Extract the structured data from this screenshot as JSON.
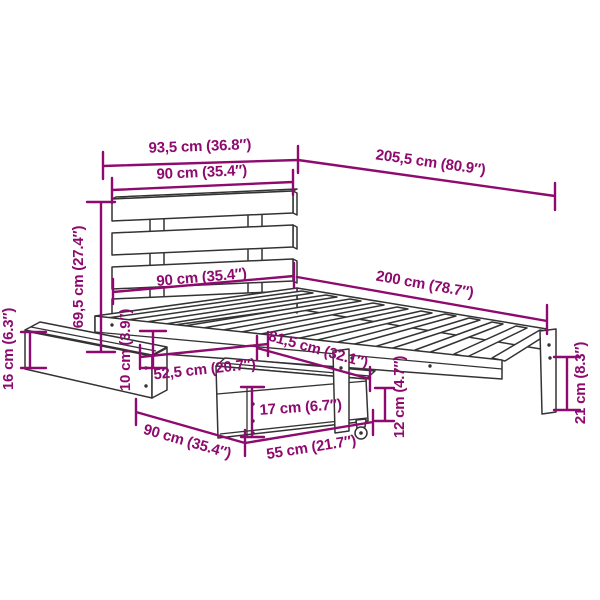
{
  "diagram": {
    "type": "product-dimension-drawing",
    "subject": "bed frame with slatted headboard, slat base, two underbed drawers with casters",
    "style": {
      "dimension_color": "#8E0A6E",
      "outline_color": "#333333",
      "background": "#FFFFFF"
    },
    "dims": {
      "headboard_total_width": "93,5 cm (36.8″)",
      "total_length": "205,5 cm (80.9″)",
      "headboard_width": "90 cm (35.4″)",
      "headboard_height": "69,5 cm (27.4″)",
      "bed_width": "90 cm (35.4″)",
      "bed_length": "200 cm (78.7″)",
      "left_drawer_height": "16 cm (6.3″)",
      "rail_height": "10 cm (3.9″)",
      "drawer_depth": "52,5 cm (20.7″)",
      "foot_section_length": "81,5 cm (32.1″)",
      "drawer_front_height": "17 cm (6.7″)",
      "drawer_width": "90 cm (35.4″)",
      "drawer_pullout": "55 cm (21.7″)",
      "caster_height": "12 cm (4.7″)",
      "leg_height": "21 cm (8.3″)"
    }
  }
}
